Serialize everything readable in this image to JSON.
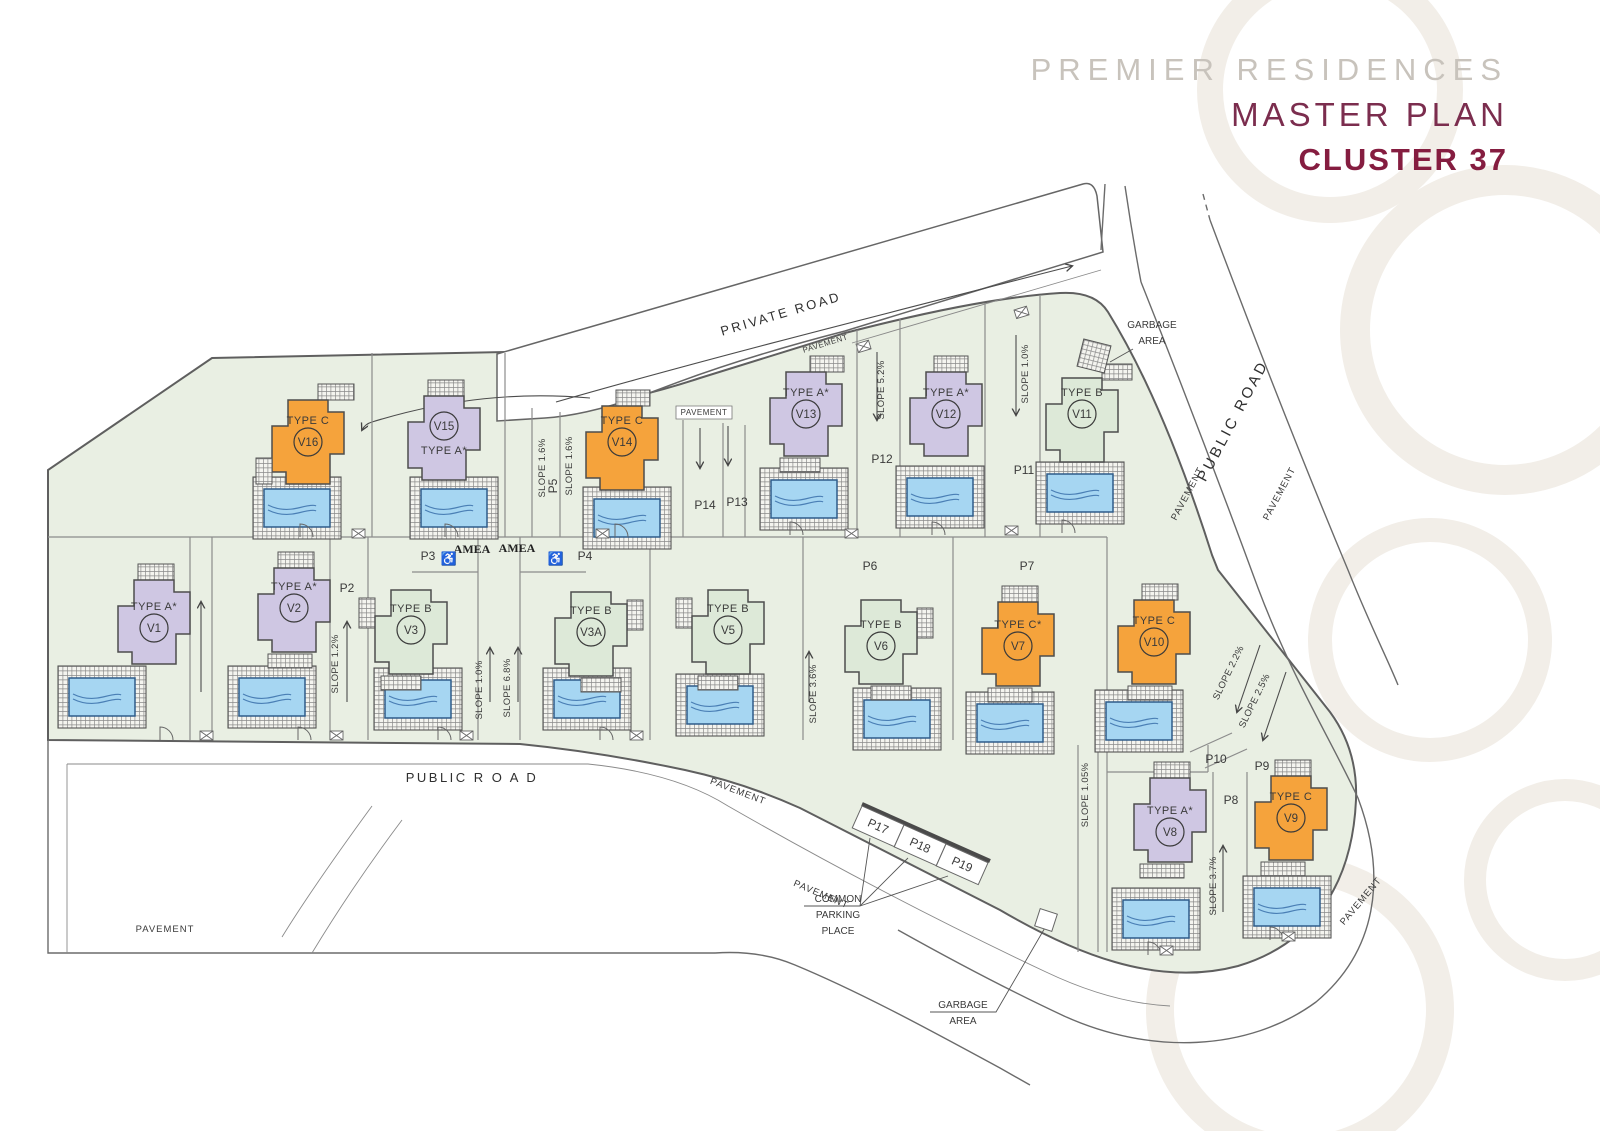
{
  "title": {
    "brand": "PREMIER RESIDENCES",
    "plan": "MASTER PLAN",
    "cluster": "CLUSTER 37"
  },
  "palette": {
    "brand_gray": "#c8c3bc",
    "maroon": "#7b2d4e",
    "maroon_bold": "#851d40",
    "type_a": "#cfc7e3",
    "type_b": "#dde9d8",
    "type_c": "#f5a33c",
    "plot_green": "#e9efe3",
    "pool_blue": "#a6d6f2"
  },
  "villas": [
    {
      "id": "V16",
      "type": "TYPE C"
    },
    {
      "id": "V15",
      "type": "TYPE A*"
    },
    {
      "id": "V14",
      "type": "TYPE C"
    },
    {
      "id": "V13",
      "type": "TYPE A*"
    },
    {
      "id": "V12",
      "type": "TYPE A*"
    },
    {
      "id": "V11",
      "type": "TYPE B"
    },
    {
      "id": "V1",
      "type": "TYPE A*"
    },
    {
      "id": "V2",
      "type": "TYPE A*"
    },
    {
      "id": "V3",
      "type": "TYPE B"
    },
    {
      "id": "V3A",
      "type": "TYPE B"
    },
    {
      "id": "V5",
      "type": "TYPE B"
    },
    {
      "id": "V6",
      "type": "TYPE B"
    },
    {
      "id": "V7",
      "type": "TYPE C*"
    },
    {
      "id": "V10",
      "type": "TYPE C"
    },
    {
      "id": "V8",
      "type": "TYPE A*"
    },
    {
      "id": "V9",
      "type": "TYPE C"
    }
  ],
  "roads": {
    "private": "PRIVATE ROAD",
    "public_right": "PUBLIC ROAD",
    "public_bottom": "PUBLIC R O A D"
  },
  "labels": {
    "pavement": "PAVEMENT",
    "amea": "AMEA",
    "garbage_l1": "GARBAGE",
    "garbage_l2": "AREA",
    "parking_l1": "COMMON",
    "parking_l2": "PARKING",
    "parking_l3": "PLACE"
  },
  "icons": {
    "wheelchair": "♿"
  },
  "parking": {
    "p2": "P2",
    "p3": "P3",
    "p4": "P4",
    "p5": "P5",
    "p6": "P6",
    "p7": "P7",
    "p8": "P8",
    "p9": "P9",
    "p10": "P10",
    "p11": "P11",
    "p12": "P12",
    "p13": "P13",
    "p14": "P14",
    "p17": "P17",
    "p18": "P18",
    "p19": "P19"
  },
  "slopes": {
    "s1": "SLOPE 1.6%",
    "s2": "SLOPE 1.6%",
    "s3": "SLOPE 5.2%",
    "s4": "SLOPE 1.0%",
    "s5": "SLOPE 1.2%",
    "s6": "SLOPE 1.0%",
    "s7": "SLOPE 6.8%",
    "s8": "SLOPE 3.6%",
    "s9": "SLOPE 1.05%",
    "s10": "SLOPE 2.2%",
    "s11": "SLOPE 2.5%",
    "s12": "SLOPE 3.7%"
  }
}
